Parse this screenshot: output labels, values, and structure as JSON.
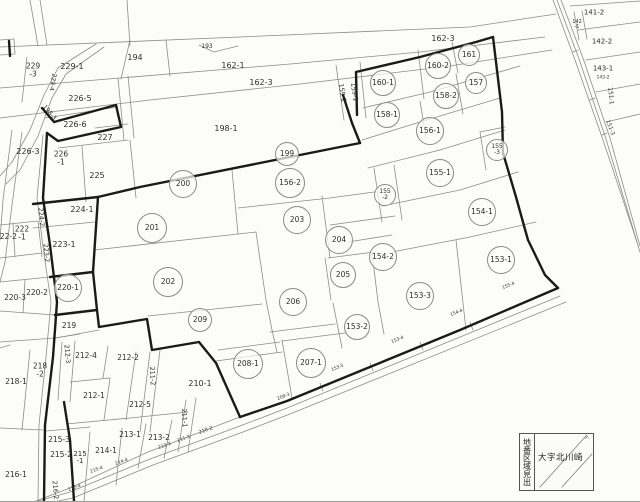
{
  "colors": {
    "background": "#fcfcfa",
    "thin_line": "#8c8c8c",
    "bold_line": "#1a1a1a",
    "text": "#2e2e2e"
  },
  "legend": {
    "vertical_label": "地番区域見出",
    "area_name": "大字北川崎",
    "corner_mark": "入"
  },
  "map": {
    "parcels": [
      {
        "t": "199",
        "x": 287,
        "y": 154,
        "k": "c",
        "r": 11
      },
      {
        "t": "200",
        "x": 183,
        "y": 184,
        "k": "c",
        "r": 13
      },
      {
        "t": "156-2",
        "x": 290,
        "y": 183,
        "k": "c",
        "r": 14
      },
      {
        "t": "201",
        "x": 152,
        "y": 228,
        "k": "c",
        "r": 14
      },
      {
        "t": "203",
        "x": 297,
        "y": 220,
        "k": "c",
        "r": 13
      },
      {
        "t": "204",
        "x": 339,
        "y": 240,
        "k": "c",
        "r": 13
      },
      {
        "t": "154-2",
        "x": 383,
        "y": 257,
        "k": "c",
        "r": 13
      },
      {
        "t": "205",
        "x": 343,
        "y": 275,
        "k": "c",
        "r": 12
      },
      {
        "t": "202",
        "x": 168,
        "y": 282,
        "k": "c",
        "r": 14
      },
      {
        "t": "153-3",
        "x": 420,
        "y": 296,
        "k": "c",
        "r": 13
      },
      {
        "t": "206",
        "x": 293,
        "y": 302,
        "k": "c",
        "r": 13
      },
      {
        "t": "209",
        "x": 200,
        "y": 320,
        "k": "c",
        "r": 11
      },
      {
        "t": "153-2",
        "x": 357,
        "y": 327,
        "k": "c",
        "r": 12
      },
      {
        "t": "208-1",
        "x": 248,
        "y": 364,
        "k": "c",
        "r": 14
      },
      {
        "t": "207-1",
        "x": 311,
        "y": 363,
        "k": "c",
        "r": 14
      },
      {
        "t": "153-1",
        "x": 501,
        "y": 260,
        "k": "c",
        "r": 13
      },
      {
        "t": "154-1",
        "x": 482,
        "y": 212,
        "k": "c",
        "r": 13
      },
      {
        "t": "155-1",
        "x": 440,
        "y": 173,
        "k": "c",
        "r": 13
      },
      {
        "t": "156-1",
        "x": 430,
        "y": 131,
        "k": "c",
        "r": 13
      },
      {
        "t": "158-1",
        "x": 387,
        "y": 115,
        "k": "c",
        "r": 12
      },
      {
        "t": "158-2",
        "x": 446,
        "y": 96,
        "k": "c",
        "r": 12
      },
      {
        "t": "160-1",
        "x": 383,
        "y": 83,
        "k": "c",
        "r": 12
      },
      {
        "t": "160-2",
        "x": 438,
        "y": 66,
        "k": "c",
        "r": 12
      },
      {
        "t": "161",
        "x": 469,
        "y": 55,
        "k": "c",
        "r": 10
      },
      {
        "t": "157",
        "x": 476,
        "y": 83,
        "k": "c",
        "r": 10
      },
      {
        "t": "155|-2",
        "x": 385,
        "y": 195,
        "k": "cs",
        "r": 10,
        "s": 6
      },
      {
        "t": "155|-3",
        "x": 497,
        "y": 150,
        "k": "cs",
        "r": 10,
        "s": 6
      },
      {
        "t": "220-1",
        "x": 68,
        "y": 288,
        "k": "c",
        "r": 13
      },
      {
        "t": "193",
        "x": 207,
        "y": 47,
        "k": "p",
        "s": 6
      },
      {
        "t": "194",
        "x": 135,
        "y": 58,
        "k": "p",
        "s": 8
      },
      {
        "t": "162-1",
        "x": 233,
        "y": 66,
        "k": "p",
        "s": 8
      },
      {
        "t": "162-3",
        "x": 261,
        "y": 83,
        "k": "p",
        "s": 8
      },
      {
        "t": "198-1",
        "x": 226,
        "y": 129,
        "k": "p",
        "s": 8
      },
      {
        "t": "162-3",
        "x": 443,
        "y": 39,
        "k": "p",
        "s": 8
      },
      {
        "t": "229-1",
        "x": 72,
        "y": 67,
        "k": "p",
        "s": 8
      },
      {
        "t": "229|-3",
        "x": 33,
        "y": 70,
        "k": "st",
        "s": 7.5
      },
      {
        "t": "229-4",
        "x": 52,
        "y": 82,
        "k": "v",
        "a": 100,
        "s": 6
      },
      {
        "t": "198-3",
        "x": 49,
        "y": 113,
        "k": "v",
        "a": 50,
        "s": 6
      },
      {
        "t": "226-5",
        "x": 80,
        "y": 99,
        "k": "p",
        "s": 8
      },
      {
        "t": "226-6",
        "x": 75,
        "y": 125,
        "k": "p",
        "s": 8
      },
      {
        "t": "227",
        "x": 105,
        "y": 138,
        "k": "p",
        "s": 8
      },
      {
        "t": "226-3",
        "x": 28,
        "y": 152,
        "k": "p",
        "s": 8
      },
      {
        "t": "226|-1",
        "x": 61,
        "y": 158,
        "k": "st",
        "s": 7.5
      },
      {
        "t": "225",
        "x": 97,
        "y": 176,
        "k": "p",
        "s": 8
      },
      {
        "t": "224-1",
        "x": 82,
        "y": 210,
        "k": "p",
        "s": 8
      },
      {
        "t": "224-2",
        "x": 41,
        "y": 217,
        "k": "v",
        "a": 85,
        "s": 6.5
      },
      {
        "t": "222|-1",
        "x": 22,
        "y": 233,
        "k": "st",
        "s": 7.5
      },
      {
        "t": "222-2",
        "x": 6,
        "y": 237,
        "k": "p",
        "s": 7.5
      },
      {
        "t": "223-2",
        "x": 46,
        "y": 253,
        "k": "v",
        "a": 85,
        "s": 6.5
      },
      {
        "t": "223-1",
        "x": 64,
        "y": 245,
        "k": "p",
        "s": 8
      },
      {
        "t": "220-2",
        "x": 37,
        "y": 293,
        "k": "p",
        "s": 7.5
      },
      {
        "t": "220-3",
        "x": 15,
        "y": 298,
        "k": "p",
        "s": 7.5
      },
      {
        "t": "219",
        "x": 69,
        "y": 326,
        "k": "p",
        "s": 7.5
      },
      {
        "t": "218-1",
        "x": 16,
        "y": 382,
        "k": "p",
        "s": 7.5
      },
      {
        "t": "218|-2",
        "x": 40,
        "y": 370,
        "k": "st",
        "s": 7.5
      },
      {
        "t": "212-3",
        "x": 67,
        "y": 354,
        "k": "v",
        "a": 85,
        "s": 6.5
      },
      {
        "t": "212-4",
        "x": 86,
        "y": 356,
        "k": "p",
        "s": 7.5
      },
      {
        "t": "212-2",
        "x": 128,
        "y": 358,
        "k": "p",
        "s": 7.5
      },
      {
        "t": "212-1",
        "x": 94,
        "y": 396,
        "k": "p",
        "s": 7.5
      },
      {
        "t": "212-5",
        "x": 140,
        "y": 405,
        "k": "p",
        "s": 7.5
      },
      {
        "t": "211-2",
        "x": 152,
        "y": 376,
        "k": "v",
        "a": 87,
        "s": 6.5
      },
      {
        "t": "211-1",
        "x": 184,
        "y": 418,
        "k": "v",
        "a": 87,
        "s": 6.5
      },
      {
        "t": "210-1",
        "x": 200,
        "y": 384,
        "k": "p",
        "s": 8
      },
      {
        "t": "213-1",
        "x": 130,
        "y": 435,
        "k": "p",
        "s": 7.5
      },
      {
        "t": "213-2",
        "x": 159,
        "y": 438,
        "k": "p",
        "s": 7.5
      },
      {
        "t": "214-1",
        "x": 106,
        "y": 451,
        "k": "p",
        "s": 7.5
      },
      {
        "t": "215-3",
        "x": 59,
        "y": 440,
        "k": "p",
        "s": 7.5
      },
      {
        "t": "215-2",
        "x": 61,
        "y": 455,
        "k": "p",
        "s": 7.5
      },
      {
        "t": "215|-1",
        "x": 80,
        "y": 458,
        "k": "st",
        "s": 7
      },
      {
        "t": "216-1",
        "x": 16,
        "y": 475,
        "k": "p",
        "s": 7.5
      },
      {
        "t": "216-2",
        "x": 55,
        "y": 490,
        "k": "v",
        "a": 85,
        "s": 6.5
      },
      {
        "t": "159-2",
        "x": 342,
        "y": 93,
        "k": "v",
        "a": 80,
        "s": 6.5
      },
      {
        "t": "159-1",
        "x": 354,
        "y": 92,
        "k": "v",
        "a": 80,
        "s": 6.5
      },
      {
        "t": "141-2",
        "x": 594,
        "y": 13,
        "k": "p",
        "s": 7
      },
      {
        "t": "142|-1",
        "x": 577,
        "y": 25,
        "k": "st",
        "s": 5
      },
      {
        "t": "142-2",
        "x": 602,
        "y": 42,
        "k": "p",
        "s": 7
      },
      {
        "t": "143-1",
        "x": 603,
        "y": 69,
        "k": "p",
        "s": 7
      },
      {
        "t": "143-2",
        "x": 603,
        "y": 79,
        "k": "p",
        "s": 4.5
      },
      {
        "t": "151-1",
        "x": 610,
        "y": 96,
        "k": "v",
        "a": 85,
        "s": 6
      },
      {
        "t": "151-3",
        "x": 609,
        "y": 128,
        "k": "v",
        "a": 70,
        "s": 5.5
      },
      {
        "t": "210-2",
        "x": 206,
        "y": 431,
        "k": "r",
        "a": -20,
        "s": 5
      },
      {
        "t": "211-3",
        "x": 184,
        "y": 440,
        "k": "r",
        "a": -20,
        "s": 4.5
      },
      {
        "t": "213-3",
        "x": 165,
        "y": 447,
        "k": "r",
        "a": -20,
        "s": 4.5
      },
      {
        "t": "214-4",
        "x": 122,
        "y": 463,
        "k": "r",
        "a": -20,
        "s": 4.5
      },
      {
        "t": "215-4",
        "x": 97,
        "y": 471,
        "k": "r",
        "a": -20,
        "s": 4.5
      },
      {
        "t": "216-4",
        "x": 75,
        "y": 489,
        "k": "r",
        "a": -20,
        "s": 4.5
      },
      {
        "t": "208-3",
        "x": 284,
        "y": 398,
        "k": "r",
        "a": -22,
        "s": 4.5
      },
      {
        "t": "153-5",
        "x": 338,
        "y": 369,
        "k": "r",
        "a": -22,
        "s": 4.5
      },
      {
        "t": "153-4",
        "x": 398,
        "y": 341,
        "k": "r",
        "a": -22,
        "s": 4.5
      },
      {
        "t": "154-4",
        "x": 457,
        "y": 314,
        "k": "r",
        "a": -22,
        "s": 4.5
      },
      {
        "t": "155-4",
        "x": 509,
        "y": 287,
        "k": "r",
        "a": -22,
        "s": 4.5
      },
      {
        "t": "入",
        "x": 587,
        "y": 438,
        "k": "p",
        "s": 5
      }
    ]
  }
}
